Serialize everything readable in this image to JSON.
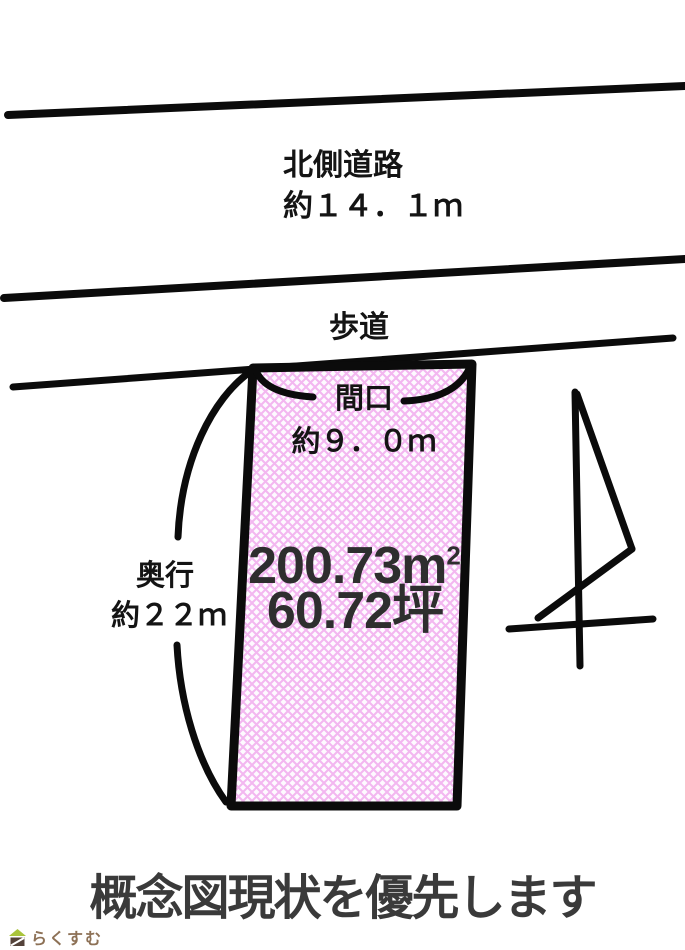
{
  "colors": {
    "ink": "#0b0b0b",
    "label_text": "#141414",
    "area_text": "#2e2e2e",
    "disclaimer_text": "#3a3a3a",
    "hatch_line": "#f0a6ec",
    "hatch_bg": "#fefaff",
    "logo_text": "#8d7156",
    "logo_roof": "#a9c43b",
    "logo_body": "#54433a"
  },
  "north_road": {
    "name": "北側道路",
    "width": "約１４．１ｍ"
  },
  "sidewalk": {
    "label": "歩道"
  },
  "plot": {
    "frontage_label": "間口",
    "frontage_value": "約９．０ｍ",
    "depth_label": "奥行",
    "depth_value": "約２２ｍ",
    "area_value": "200.73",
    "area_unit": "m",
    "area_exponent": "2",
    "area_tsubo": "60.72坪"
  },
  "compass": {
    "icon": "north-arrow-icon"
  },
  "footer": {
    "disclaimer": "概念図現状を優先します",
    "logo_icon": "house-icon",
    "logo_text": "らくすむ"
  }
}
